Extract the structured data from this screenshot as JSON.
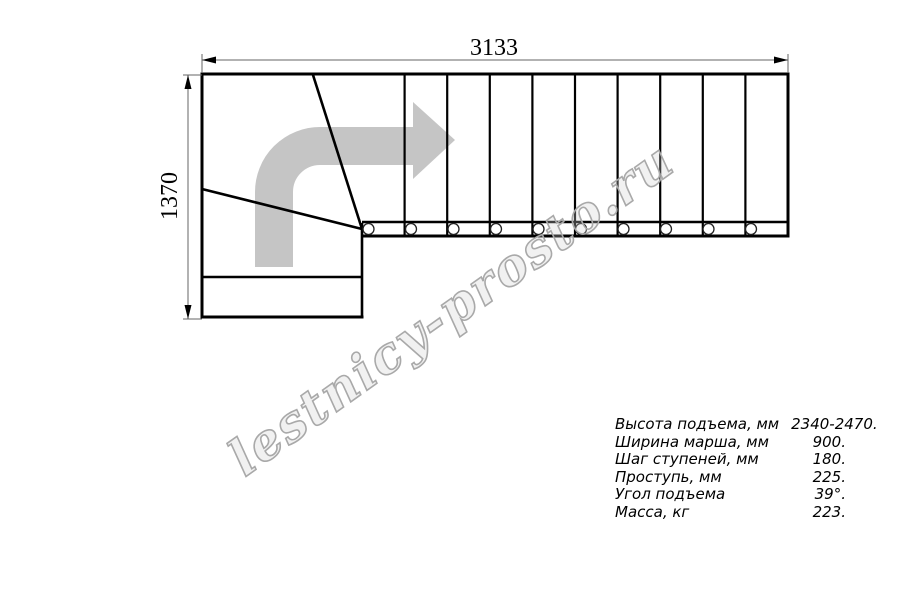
{
  "dimensions": {
    "width": "3133",
    "height": "1370"
  },
  "plan": {
    "straight_treads": 10,
    "tread_pins": 10,
    "direction": "up-then-right"
  },
  "watermark": {
    "text": "lestnicy-prosto.ru"
  },
  "specs": {
    "rows": [
      {
        "label": "Высота подъема, мм",
        "value": "2340-2470."
      },
      {
        "label": "Ширина марша, мм",
        "value": "900."
      },
      {
        "label": "Шаг ступеней, мм",
        "value": "180."
      },
      {
        "label": "Проступь, мм",
        "value": "225."
      },
      {
        "label": "Угол подъема",
        "value": "39°."
      },
      {
        "label": "Масса, кг",
        "value": "223."
      }
    ]
  },
  "colors": {
    "line": "#000000",
    "dimension_line": "#666666",
    "direction_arrow": "#c5c5c5",
    "watermark_stroke": "#a9a9a9",
    "watermark_fill": "rgba(210,210,210,0.30)"
  }
}
